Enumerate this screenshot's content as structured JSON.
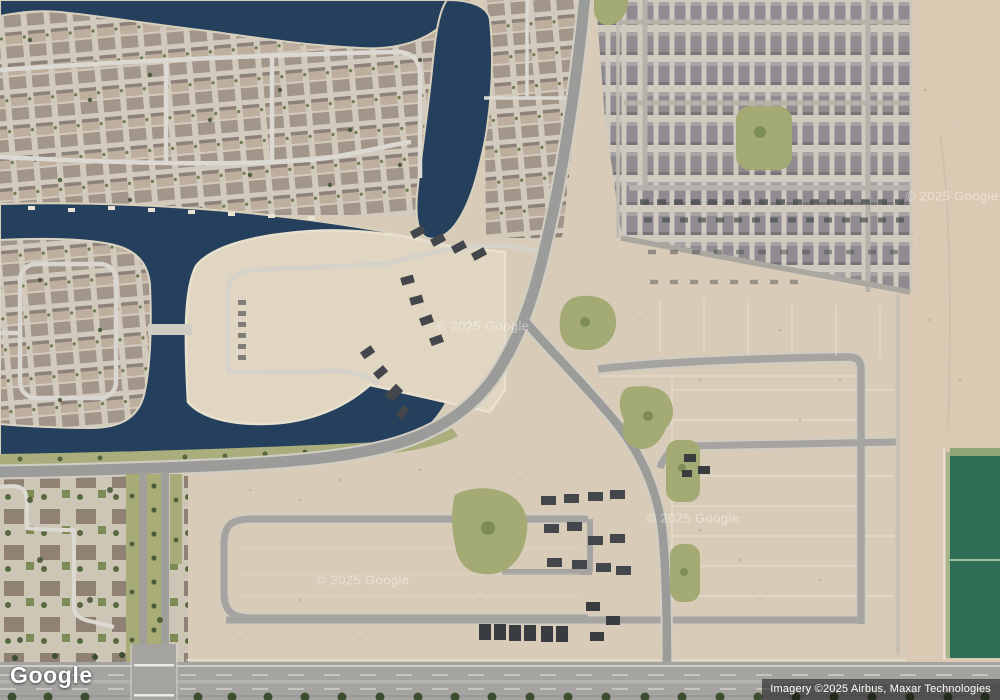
{
  "map": {
    "view_type": "satellite",
    "logo": "Google",
    "attribution": "Imagery ©2025 Airbus, Maxar Technologies",
    "watermark_text": "© 2025 Google",
    "watermarks": [
      {
        "x": 483,
        "y": 326
      },
      {
        "x": 363,
        "y": 580
      },
      {
        "x": 693,
        "y": 518
      },
      {
        "x": 952,
        "y": 196
      }
    ]
  },
  "colors": {
    "water": "#24405c",
    "land_dirt": "#d8cbb8",
    "desert": "#dcc9b4",
    "sand_beach": "#e0d6c1",
    "road_primary": "#9b9c99",
    "road_casing": "#d2cec4",
    "street_local": "#dcd9d2",
    "park_green": "#a3aa74",
    "field_green": "#2e6e54",
    "tree_green": "#42512f",
    "highway_gray": "#a4a3a0",
    "watermark": "#ffffff"
  }
}
